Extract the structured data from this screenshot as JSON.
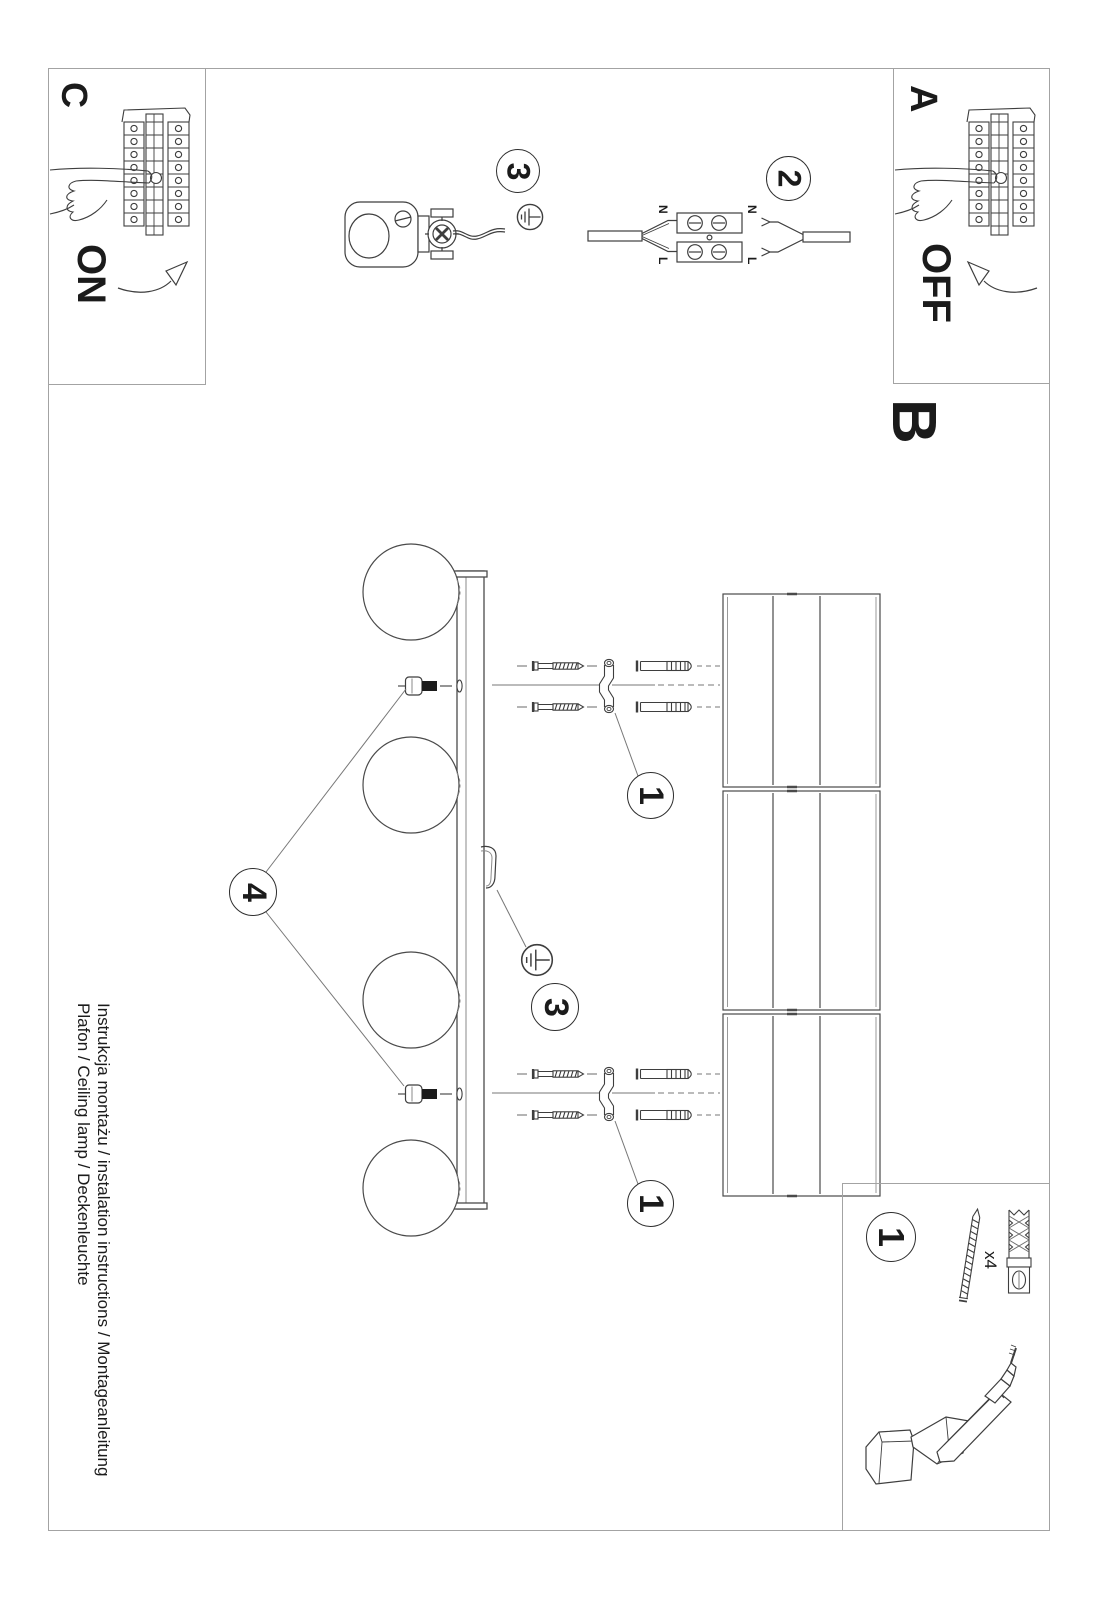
{
  "sections": {
    "a": {
      "label": "A",
      "state": "OFF"
    },
    "b": {
      "label": "B"
    },
    "c": {
      "label": "C",
      "state": "ON"
    }
  },
  "steps": {
    "step1": "1",
    "step2": "2",
    "step3": "3",
    "step4": "4"
  },
  "wiring": {
    "neutral": "N",
    "live": "L"
  },
  "parts_box": {
    "screw_qty": "x4"
  },
  "footer": {
    "line1": "Instrukcja montażu / instalation instructions / Montageanleitung",
    "line2": "Plafon / Ceiling lamp / Deckenleuchte"
  },
  "colors": {
    "line_art": "#3e3e3e",
    "frame_border": "#a3a3a3",
    "ink": "#1b1b1b"
  }
}
